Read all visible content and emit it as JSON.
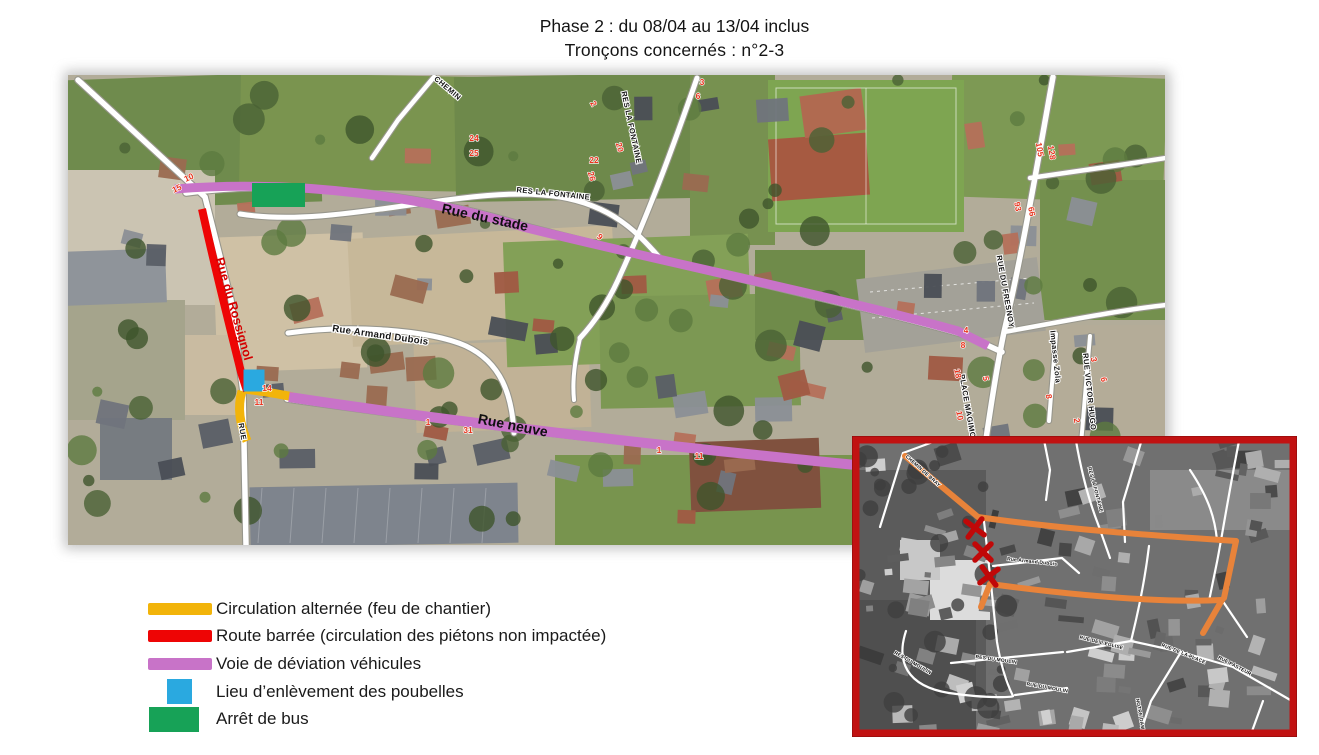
{
  "title": {
    "line1": "Phase 2 : du 08/04 au 13/04 inclus",
    "line2": "Tronçons concernés : n°2-3"
  },
  "colors": {
    "alternating": "#F2B40A",
    "closed": "#EE0505",
    "deviation": "#C873C8",
    "trash": "#2AA9E0",
    "bus": "#17A257",
    "inset_route": "#E8833A",
    "inset_border": "#C11212",
    "cross": "#C00808",
    "number": "#E8331C"
  },
  "legend": {
    "items": [
      {
        "key": "alternating",
        "shape": "bar",
        "color": "#F2B40A",
        "label": "Circulation alternée (feu de chantier)"
      },
      {
        "key": "closed",
        "shape": "bar",
        "color": "#EE0505",
        "label": "Route barrée (circulation des piétons non impactée)"
      },
      {
        "key": "deviation",
        "shape": "bar",
        "color": "#C873C8",
        "label": "Voie de déviation véhicules"
      },
      {
        "key": "trash",
        "shape": "square",
        "color": "#2AA9E0",
        "label": "Lieu d’enlèvement des poubelles"
      },
      {
        "key": "bus",
        "shape": "rect",
        "color": "#17A257",
        "label": "Arrêt de bus"
      }
    ]
  },
  "map": {
    "street_labels": [
      {
        "text": "Rue du stade",
        "x": 484,
        "y": 222,
        "r": 12,
        "s": "onroute"
      },
      {
        "text": "Rue neuve",
        "x": 512,
        "y": 430,
        "r": 11,
        "s": "onroute"
      },
      {
        "text": "Rue du Rossignol",
        "x": 230,
        "y": 310,
        "r": 74,
        "s": "closed"
      },
      {
        "text": "Rue Armand Dubois",
        "x": 380,
        "y": 338,
        "r": 8,
        "s": "roadlg"
      },
      {
        "text": "RES LA FONTAINE",
        "x": 553,
        "y": 196,
        "r": 6,
        "s": "road"
      },
      {
        "text": "RES LA FONTAINE",
        "x": 629,
        "y": 128,
        "r": 78,
        "s": "road"
      },
      {
        "text": "CHEMIN",
        "x": 446,
        "y": 90,
        "r": 40,
        "s": "road"
      },
      {
        "text": "RUE DU FRESNOY",
        "x": 1003,
        "y": 292,
        "r": 80,
        "s": "road"
      },
      {
        "text": "PLACE MAGIMONT",
        "x": 966,
        "y": 412,
        "r": 80,
        "s": "road"
      },
      {
        "text": "RUE VICTOR HUGO",
        "x": 1087,
        "y": 392,
        "r": 84,
        "s": "road"
      },
      {
        "text": "Impasse Zola",
        "x": 1053,
        "y": 357,
        "r": 84,
        "s": "road"
      },
      {
        "text": "RUE",
        "x": 240,
        "y": 432,
        "r": 80,
        "s": "road"
      }
    ],
    "numbers": [
      {
        "t": "10",
        "x": 190,
        "y": 180,
        "r": -25
      },
      {
        "t": "15",
        "x": 178,
        "y": 191,
        "r": -25
      },
      {
        "t": "24",
        "x": 474,
        "y": 141,
        "r": 0
      },
      {
        "t": "25",
        "x": 474,
        "y": 156,
        "r": 0
      },
      {
        "t": "2",
        "x": 591,
        "y": 105,
        "r": 60
      },
      {
        "t": "22",
        "x": 594,
        "y": 163,
        "r": 0
      },
      {
        "t": "20",
        "x": 617,
        "y": 148,
        "r": 75
      },
      {
        "t": "26",
        "x": 589,
        "y": 177,
        "r": 75
      },
      {
        "t": "3",
        "x": 702,
        "y": 85,
        "r": 0
      },
      {
        "t": "6",
        "x": 698,
        "y": 99,
        "r": 0
      },
      {
        "t": "9",
        "x": 598,
        "y": 239,
        "r": 40
      },
      {
        "t": "105",
        "x": 1037,
        "y": 150,
        "r": 80
      },
      {
        "t": "128",
        "x": 1049,
        "y": 153,
        "r": 80
      },
      {
        "t": "93",
        "x": 1015,
        "y": 207,
        "r": 80
      },
      {
        "t": "66",
        "x": 1029,
        "y": 212,
        "r": 80
      },
      {
        "t": "29",
        "x": 1206,
        "y": 178,
        "r": 70
      },
      {
        "t": "28",
        "x": 1212,
        "y": 195,
        "r": 70
      },
      {
        "t": "4",
        "x": 966,
        "y": 333,
        "r": 0
      },
      {
        "t": "8",
        "x": 963,
        "y": 348,
        "r": 0
      },
      {
        "t": "18",
        "x": 955,
        "y": 374,
        "r": 80
      },
      {
        "t": "5",
        "x": 983,
        "y": 379,
        "r": 80
      },
      {
        "t": "10",
        "x": 957,
        "y": 416,
        "r": 80
      },
      {
        "t": "3",
        "x": 1091,
        "y": 360,
        "r": 80
      },
      {
        "t": "6",
        "x": 1101,
        "y": 380,
        "r": 80
      },
      {
        "t": "8",
        "x": 1046,
        "y": 397,
        "r": 80
      },
      {
        "t": "2",
        "x": 1074,
        "y": 421,
        "r": 80
      },
      {
        "t": "1",
        "x": 1098,
        "y": 452,
        "r": 0
      },
      {
        "t": "14",
        "x": 267,
        "y": 391,
        "r": 0
      },
      {
        "t": "11",
        "x": 259,
        "y": 405,
        "r": 0
      },
      {
        "t": "1",
        "x": 428,
        "y": 425,
        "r": 0
      },
      {
        "t": "31",
        "x": 468,
        "y": 433,
        "r": 0
      },
      {
        "t": "1",
        "x": 659,
        "y": 453,
        "r": 0
      },
      {
        "t": "11",
        "x": 699,
        "y": 459,
        "r": 0
      }
    ]
  },
  "inset": {
    "labels": [
      {
        "text": "CHEMIN DE BRAY",
        "x": 922,
        "y": 472,
        "r": 42
      },
      {
        "text": "RES LA FONTAINE",
        "x": 1094,
        "y": 490,
        "r": 75
      },
      {
        "text": "Rue Armand Dubois",
        "x": 1032,
        "y": 563,
        "r": 6
      },
      {
        "text": "RES DU MOULIN",
        "x": 996,
        "y": 661,
        "r": 8
      },
      {
        "text": "RES DU MOULIN",
        "x": 912,
        "y": 664,
        "r": 30
      },
      {
        "text": "RUE DU MOULIN",
        "x": 1047,
        "y": 689,
        "r": 10
      },
      {
        "text": "RUE DE L'EGLISE",
        "x": 1101,
        "y": 644,
        "r": 14
      },
      {
        "text": "RUE DE LA PLACE",
        "x": 1183,
        "y": 655,
        "r": 22
      },
      {
        "text": "RUE PASTEUR",
        "x": 1234,
        "y": 667,
        "r": 28
      },
      {
        "text": "NOTRE DAME",
        "x": 1139,
        "y": 716,
        "r": 80
      }
    ],
    "crosses": [
      {
        "x": 975,
        "y": 528
      },
      {
        "x": 983,
        "y": 552
      },
      {
        "x": 989,
        "y": 576
      }
    ]
  }
}
